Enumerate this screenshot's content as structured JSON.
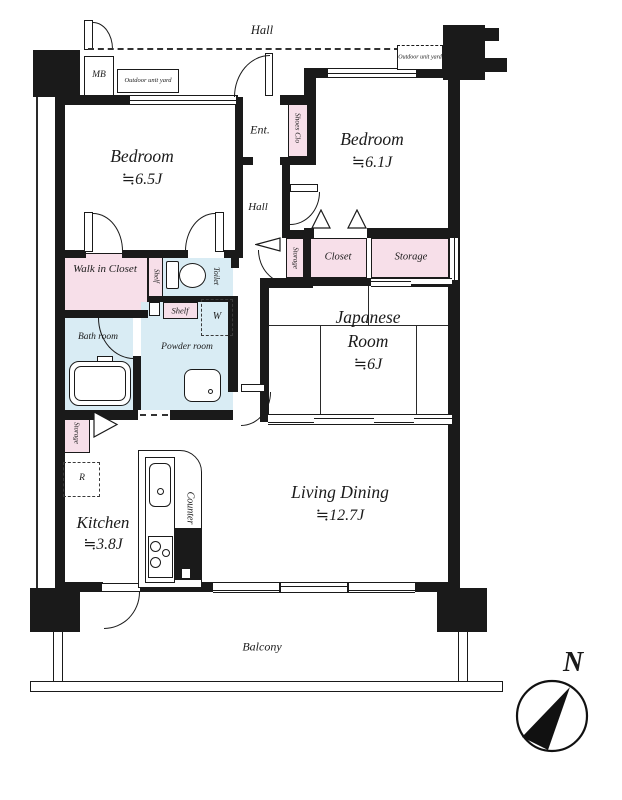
{
  "floorplan": {
    "common_hall": "Hall",
    "mb": "MB",
    "outdoor_unit_yard_left": "Outdoor unit yard",
    "outdoor_unit_yard_right": "Outdoor unit yard",
    "entrance": "Ent.",
    "shoes_closet": "Shoes Clo",
    "inner_hall": "Hall",
    "bedroom1_name": "Bedroom",
    "bedroom1_size": "≒6.5J",
    "bedroom2_name": "Bedroom",
    "bedroom2_size": "≒6.1J",
    "walk_in_closet": "Walk in Closet",
    "shelf_tall": "Shelf",
    "toilet": "Toilet",
    "shelf_small": "Shelf",
    "washer": "W",
    "storage_hall": "Storage",
    "closet": "Closet",
    "storage_bedroom": "Storage",
    "japanese_name": "Japanese Room",
    "japanese_size": "≒6J",
    "bath": "Bath room",
    "powder": "Powder room",
    "storage_kitchen": "Storage",
    "fridge": "R",
    "kitchen_name": "Kitchen",
    "kitchen_size": "≒3.8J",
    "counter": "Counter",
    "living_name": "Living Dining",
    "living_size": "≒12.7J",
    "balcony": "Balcony",
    "compass_north": "N",
    "colors": {
      "wall": "#1a1a1a",
      "closet_pink": "#f7dfe9",
      "wet_blue": "#d9ecf4"
    }
  }
}
